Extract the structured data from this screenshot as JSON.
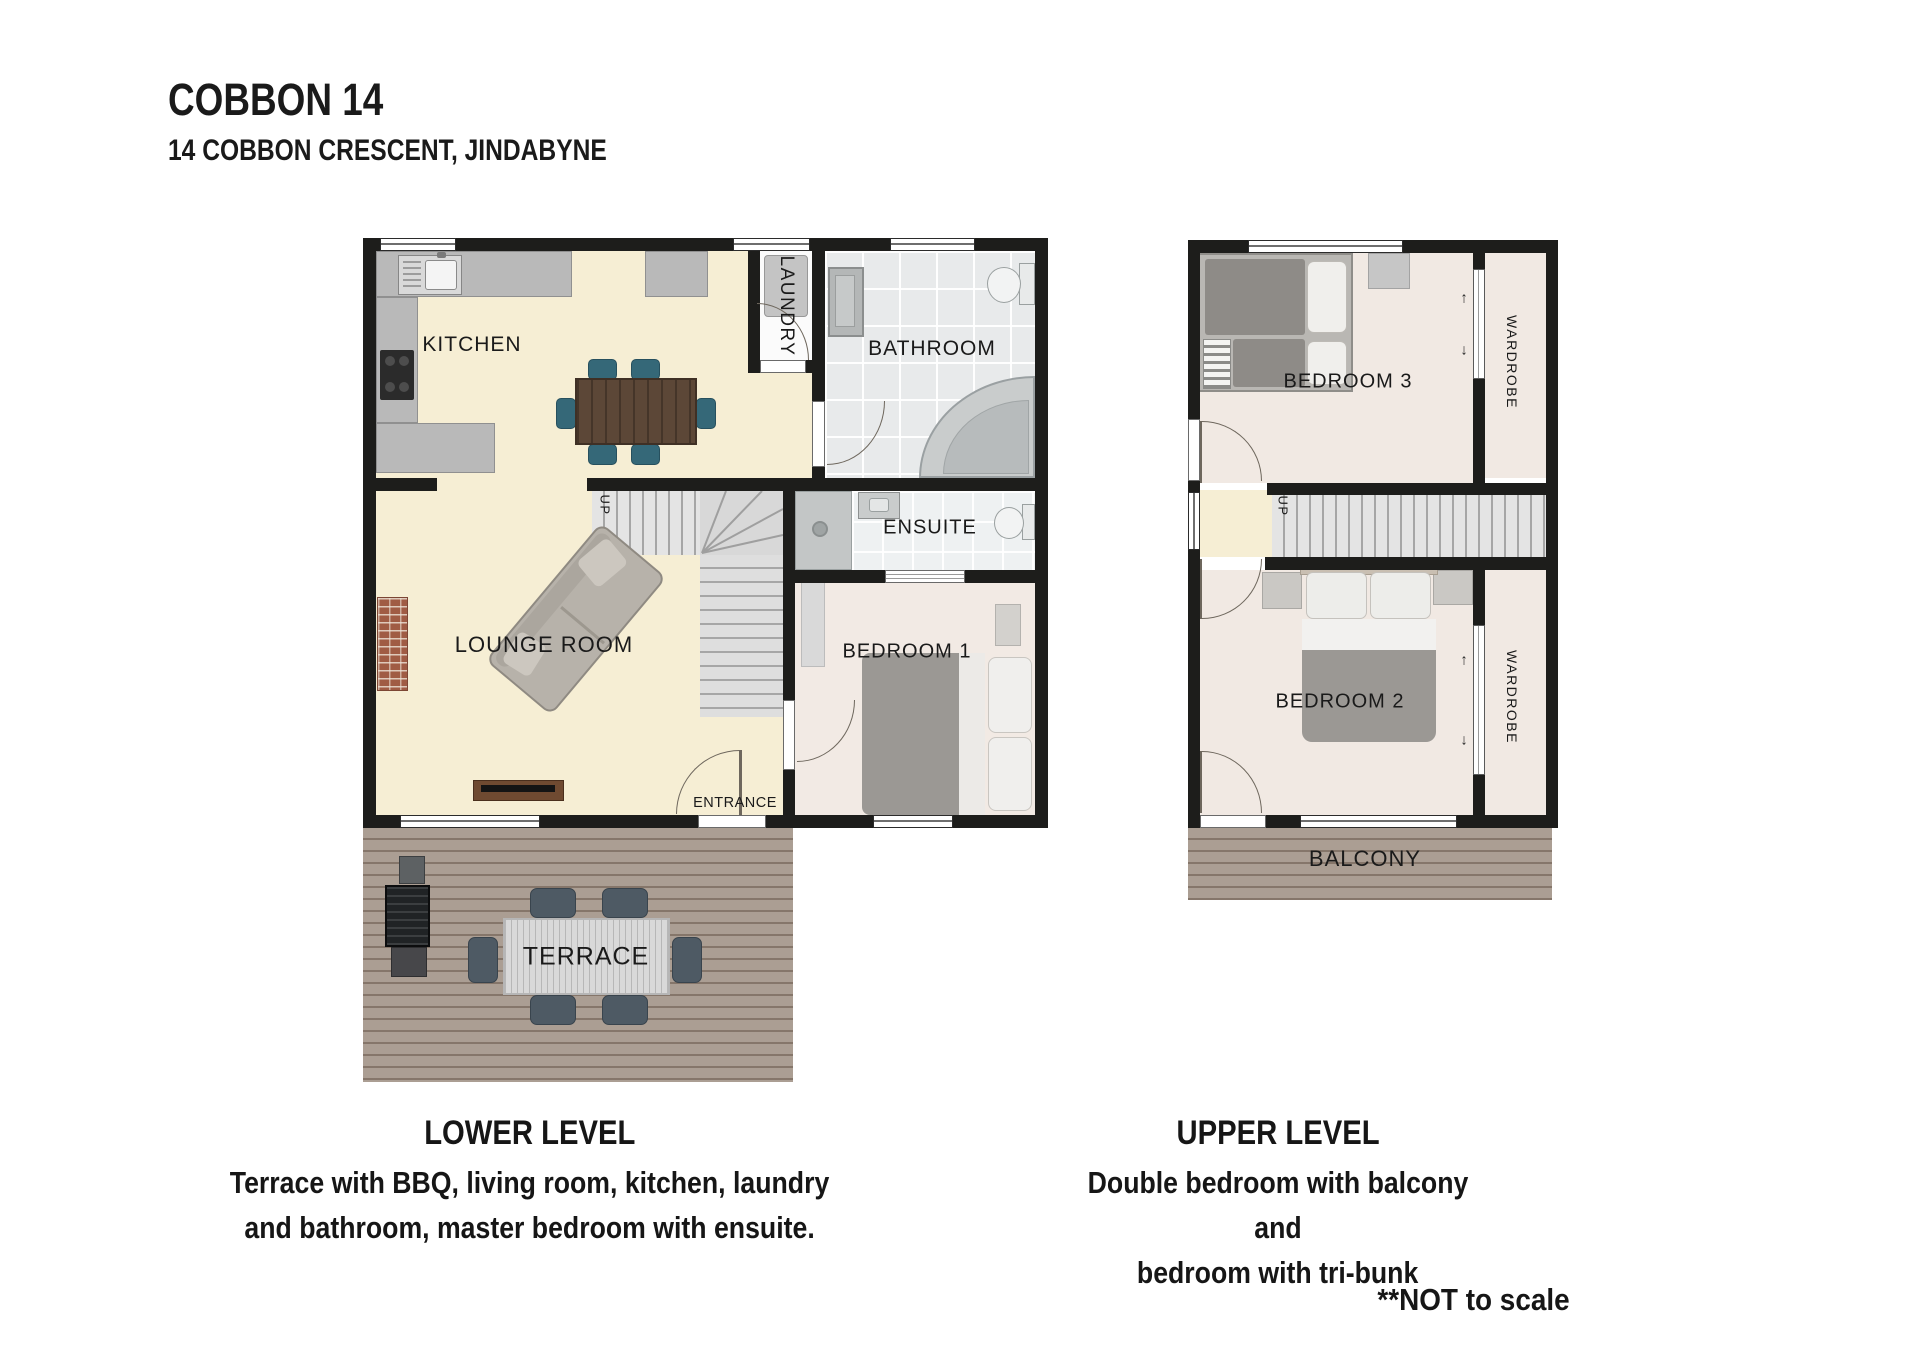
{
  "header": {
    "title": "COBBON 14",
    "address": "14 COBBON CRESCENT, JINDABYNE"
  },
  "lower": {
    "kitchen": "KITCHEN",
    "laundry": "LAUNDRY",
    "bathroom": "BATHROOM",
    "ensuite": "ENSUITE",
    "lounge": "LOUNGE ROOM",
    "bedroom1": "BEDROOM 1",
    "entrance": "ENTRANCE",
    "terrace": "TERRACE",
    "up": "UP"
  },
  "upper": {
    "bedroom3": "BEDROOM 3",
    "bedroom2": "BEDROOM 2",
    "wardrobe_top": "WARDROBE",
    "wardrobe_bottom": "WARDROBE",
    "balcony": "BALCONY",
    "up": "UP",
    "arrow_up": "↑",
    "arrow_down": "↓"
  },
  "captions": {
    "lower_heading": "LOWER LEVEL",
    "lower_line1": "Terrace with BBQ, living room, kitchen, laundry",
    "lower_line2": "and bathroom, master bedroom with ensuite.",
    "upper_heading": "UPPER LEVEL",
    "upper_line1": "Double bedroom with balcony and",
    "upper_line2": "bedroom with tri-bunk",
    "footnote": "**NOT to scale"
  },
  "colors": {
    "wall": "#1d1d1b",
    "floor_cream": "#f6eed4",
    "floor_bedroom": "#f1e9e3",
    "tile": "#e8eaeb",
    "deck": "#ab9e93",
    "counter": "#b9b9b9"
  }
}
